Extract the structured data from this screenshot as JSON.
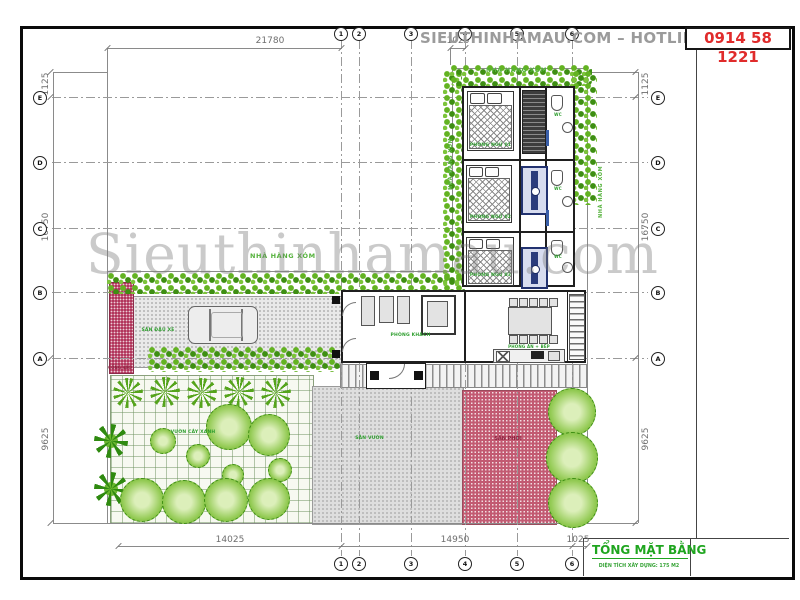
{
  "banner": {
    "label": "SIEUTHINHAMAU.COM – HOTLINE",
    "phone": "0914 58 1221"
  },
  "watermark": "Sieuthinhamau.com",
  "grid": {
    "cols": [
      "1",
      "2",
      "3",
      "4",
      "5",
      "6"
    ],
    "rows": [
      "E",
      "D",
      "C",
      "B",
      "A"
    ]
  },
  "dims": {
    "top_width": "21780",
    "top_offset": "1025",
    "side_top": "1125",
    "side_mid": "16750",
    "side_bottom": "9625",
    "bottom_left": "14025",
    "bottom_mid": "14950",
    "bottom_right": "1025"
  },
  "neighbors": {
    "top": "NHÀ HÀNG XÓM",
    "left": "NHÀ HÀNG XÓM",
    "right": "NHÀ HÀNG XÓM",
    "middle": "NHÀ HÀNG XÓM"
  },
  "rooms": {
    "bedroom1": "PHÒNG NGỦ 01",
    "bedroom2": "PHÒNG NGỦ 02",
    "bedroom3": "PHÒNG NGỦ 03",
    "living": "PHÒNG KHÁCH",
    "dining": "PHÒNG ĂN + BẾP",
    "wc": "WC"
  },
  "site": {
    "parking": "SÂN ĐẬU XE",
    "gate": "CỔNG VÀO",
    "garden": "VƯỜN CÂY XANH",
    "yard": "SÂN VƯỜN",
    "drying": "SÂN PHƠI"
  },
  "title_block": {
    "title": "TỔNG MẶT BẰNG",
    "subtitle": "DIỆN TÍCH XÂY DỰNG: 175 M2"
  },
  "colors": {
    "accent_green": "#21a121",
    "phone_red": "#e02b2b",
    "hedge_green": "#5aa41e",
    "paving_pink": "#c25a72"
  }
}
